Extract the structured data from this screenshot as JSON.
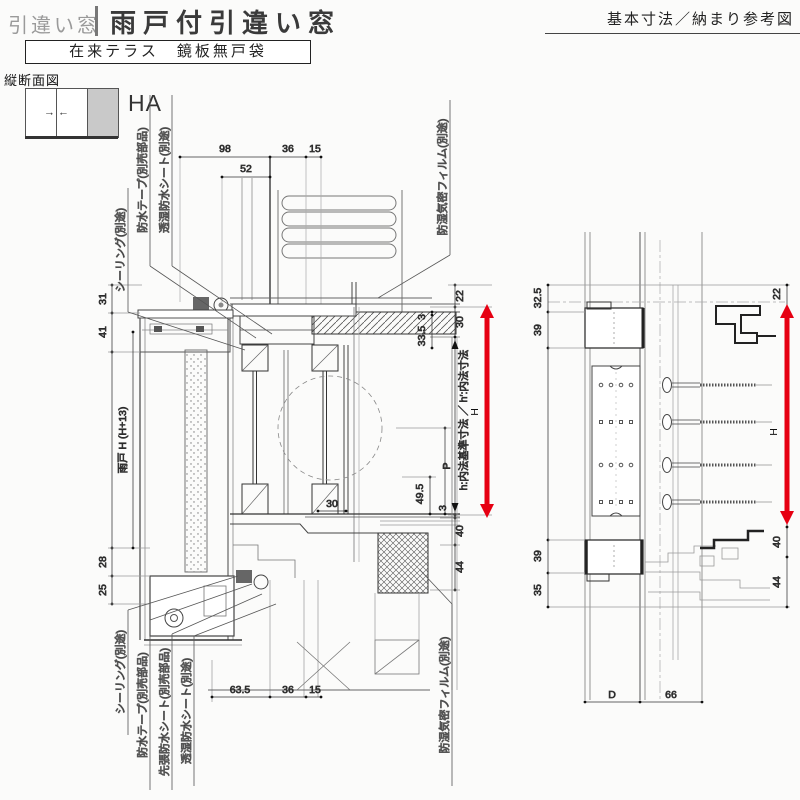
{
  "header": {
    "category": "引違い窓",
    "title": "雨戸付引違い窓",
    "doc_type": "基本寸法／納まり参考図",
    "subtitle": "在来テラス　鏡板無戸袋"
  },
  "view": {
    "label": "縦断面図",
    "code": "HA",
    "icon_arrows": {
      "left_panel": "→",
      "right_panel": "←"
    }
  },
  "section": {
    "callouts_top": {
      "sealing": "シーリング(別途)",
      "tape": "防水テープ(別売部品)",
      "sheet": "透湿防水シート(別途)",
      "film": "防湿気密フィルム(別途)"
    },
    "callouts_bottom": {
      "sealing": "シーリング(別途)",
      "tape": "防水テープ(別売部品)",
      "sakibari": "先張防水シート(別売部品)",
      "sheet": "透湿防水シート(別途)",
      "film": "防湿気密フィルム(別途)"
    },
    "dims": {
      "top98": "98",
      "top52": "52",
      "top36": "36",
      "top15": "15",
      "left31": "31",
      "left41": "41",
      "amado": "雨戸 H (H+13)",
      "left28": "28",
      "left25": "25",
      "r22": "22",
      "r30": "30",
      "r3_head": "3",
      "r335": "33.5",
      "uchinori": "h:内法基準寸法 ／ h′:内法寸法",
      "p": "P",
      "h": "H",
      "r495": "49.5",
      "r30b": "30",
      "r3_floor": "3",
      "r40": "40",
      "r44": "44",
      "b635": "63.5",
      "b36": "36",
      "b15": "15"
    }
  },
  "jamb": {
    "dims": {
      "l325": "32.5",
      "l39_top": "39",
      "l39_bottom": "39",
      "l35": "35",
      "r22": "22",
      "h": "H",
      "r40": "40",
      "r44": "44",
      "bD": "D",
      "b66": "66"
    }
  },
  "colors": {
    "accent": "#e60012"
  }
}
